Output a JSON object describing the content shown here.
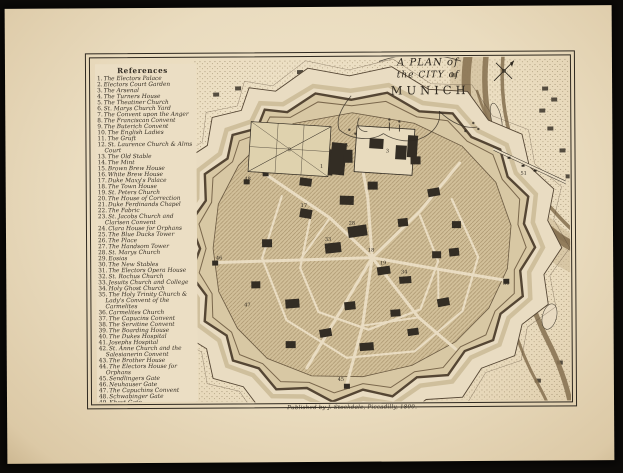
{
  "plate": {
    "title_line1": "A PLAN of",
    "title_line2": "the CITY of",
    "title_line3": "MUNICH",
    "imprint": "Published by J. Stockdale, Piccadilly, 1800."
  },
  "references": {
    "heading": "References",
    "items": [
      {
        "n": "1",
        "t": "The Electors Palace"
      },
      {
        "n": "2",
        "t": "Electors Court Garden"
      },
      {
        "n": "3",
        "t": "The Arsenal"
      },
      {
        "n": "4",
        "t": "The Turners House"
      },
      {
        "n": "5",
        "t": "The Theatiner Church"
      },
      {
        "n": "6",
        "t": "St. Marys Church Yard"
      },
      {
        "n": "7",
        "t": "The Convent upon the Anger"
      },
      {
        "n": "8",
        "t": "The Franciscan Convent"
      },
      {
        "n": "9",
        "t": "The Buterich Convent"
      },
      {
        "n": "10",
        "t": "The English Ladies"
      },
      {
        "n": "11",
        "t": "The Gruft"
      },
      {
        "n": "12",
        "t": "St. Laurence Church & Alms Court"
      },
      {
        "n": "13",
        "t": "The Old Stable"
      },
      {
        "n": "14",
        "t": "The Mint"
      },
      {
        "n": "15",
        "t": "Brown Brew House"
      },
      {
        "n": "16",
        "t": "White Brew House"
      },
      {
        "n": "17",
        "t": "Duke Maxy's Palace"
      },
      {
        "n": "18",
        "t": "The Town House"
      },
      {
        "n": "19",
        "t": "St. Peters Church"
      },
      {
        "n": "20",
        "t": "The House of Correction"
      },
      {
        "n": "21",
        "t": "Duke Ferdinands Chapel"
      },
      {
        "n": "22",
        "t": "The Fabric"
      },
      {
        "n": "23",
        "t": "St. Jacobs Church and Clarisen Convent"
      },
      {
        "n": "24",
        "t": "Clara House for Orphans"
      },
      {
        "n": "25",
        "t": "The Blue Ducks Tower"
      },
      {
        "n": "26",
        "t": "The Place"
      },
      {
        "n": "27",
        "t": "The Handsom Tower"
      },
      {
        "n": "28",
        "t": "St. Marys Church"
      },
      {
        "n": "29",
        "t": "Eosias"
      },
      {
        "n": "30",
        "t": "The New Stables"
      },
      {
        "n": "31",
        "t": "The Electors Opera House"
      },
      {
        "n": "32",
        "t": "St. Rochus Church"
      },
      {
        "n": "33",
        "t": "Jesuits Church and College"
      },
      {
        "n": "34",
        "t": "Holy Ghost Church"
      },
      {
        "n": "35",
        "t": "The Holy Trinity Church & Lady's Convent of the Carmelites"
      },
      {
        "n": "36",
        "t": "Carmelites Church"
      },
      {
        "n": "37",
        "t": "The Capucins Convent"
      },
      {
        "n": "38",
        "t": "The Servitine Convent"
      },
      {
        "n": "39",
        "t": "The Boarding House"
      },
      {
        "n": "40",
        "t": "The Dukes Hospital"
      },
      {
        "n": "41",
        "t": "Josephs Hospital"
      },
      {
        "n": "42",
        "t": "St. Anne Church and the Salesianerin Convent"
      },
      {
        "n": "43",
        "t": "The Brother House"
      },
      {
        "n": "44",
        "t": "The Electors House for Orphans"
      },
      {
        "n": "45",
        "t": "Sendlingers Gate"
      },
      {
        "n": "46",
        "t": "Neuhauser Gate"
      },
      {
        "n": "47",
        "t": "The Capuchins Convent"
      },
      {
        "n": "48",
        "t": "Schwabinger Gate"
      },
      {
        "n": "49",
        "t": "Khest Gate"
      },
      {
        "n": "50",
        "t": "Iser Gate"
      },
      {
        "n": "51",
        "t": "Iser Bridge"
      },
      {
        "n": "52",
        "t": "Wasser Tower"
      }
    ]
  },
  "map_labels": [
    {
      "t": "2",
      "x": 290,
      "y": 151
    },
    {
      "t": "1",
      "x": 322,
      "y": 168
    },
    {
      "t": "3",
      "x": 388,
      "y": 153
    },
    {
      "t": "5",
      "x": 347,
      "y": 147
    },
    {
      "t": "17",
      "x": 304,
      "y": 207
    },
    {
      "t": "18",
      "x": 371,
      "y": 252
    },
    {
      "t": "19",
      "x": 383,
      "y": 265
    },
    {
      "t": "28",
      "x": 352,
      "y": 225
    },
    {
      "t": "33",
      "x": 328,
      "y": 241
    },
    {
      "t": "34",
      "x": 404,
      "y": 274
    },
    {
      "t": "45",
      "x": 340,
      "y": 381
    },
    {
      "t": "46",
      "x": 219,
      "y": 259
    },
    {
      "t": "47",
      "x": 247,
      "y": 306
    },
    {
      "t": "48",
      "x": 248,
      "y": 180
    },
    {
      "t": "50",
      "x": 506,
      "y": 286
    },
    {
      "t": "51",
      "x": 524,
      "y": 176
    }
  ],
  "colors": {
    "paper": "#e9dcc2",
    "ink": "#2f2920",
    "stipple1": "#8d7c5e",
    "stipple2": "#9b8a68",
    "hatch_bg": "#d2c09a",
    "hatch_ln": "#a8936c",
    "wall_fill": "#d8c8a4",
    "wall_stroke": "#554634",
    "moat": "#baa77e",
    "river": "#8a7454",
    "river_light": "#c7b48d",
    "street": "#e9dcc2",
    "garden_fill": "#dfd2ae"
  }
}
